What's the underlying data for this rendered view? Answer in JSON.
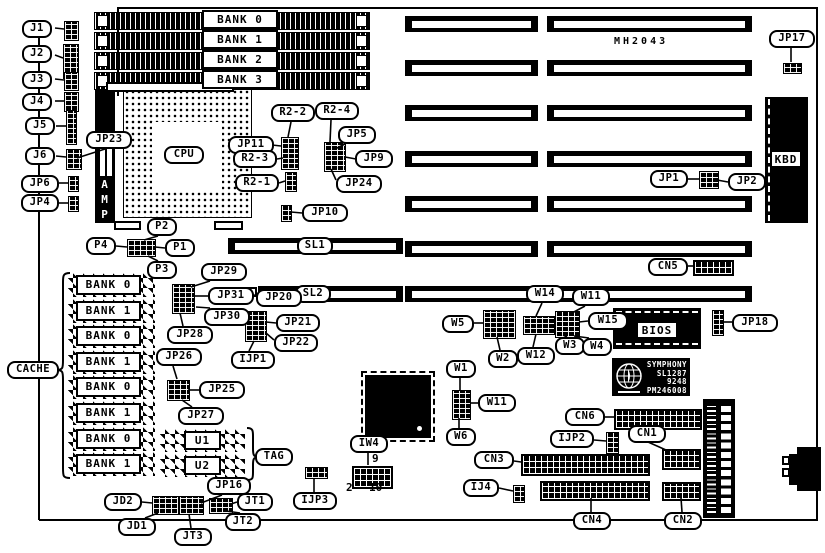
{
  "diagram": {
    "board_label": "MH2043",
    "chip_texts": {
      "cpu": "CPU",
      "amp": "AMP",
      "kbd": "KBD",
      "bios": "BIOS"
    },
    "symphony_lines": [
      "SYMPHONY",
      "SL1287",
      "9248",
      "PM246008"
    ],
    "iw4_pin_numbers": {
      "top_right": "9",
      "bottom_left": "2",
      "bottom_right": "10"
    },
    "memory_bank_labels": [
      "BANK 0",
      "BANK 1",
      "BANK 2",
      "BANK 3"
    ],
    "cache_bank_labels": [
      "BANK 0",
      "BANK 1",
      "BANK 0",
      "BANK 1",
      "BANK 0",
      "BANK 1",
      "BANK 0",
      "BANK 1"
    ],
    "tag_chip_labels": [
      "U1",
      "U2"
    ],
    "callouts": [
      {
        "t": "J1",
        "x": 22,
        "y": 20,
        "w": 30
      },
      {
        "t": "J2",
        "x": 22,
        "y": 45,
        "w": 30
      },
      {
        "t": "J3",
        "x": 22,
        "y": 71,
        "w": 30
      },
      {
        "t": "J4",
        "x": 22,
        "y": 93,
        "w": 30
      },
      {
        "t": "J5",
        "x": 25,
        "y": 117,
        "w": 30
      },
      {
        "t": "J6",
        "x": 25,
        "y": 147,
        "w": 30
      },
      {
        "t": "JP6",
        "x": 21,
        "y": 175,
        "w": 38
      },
      {
        "t": "JP4",
        "x": 21,
        "y": 194,
        "w": 38
      },
      {
        "t": "JP23",
        "x": 86,
        "y": 131,
        "w": 46
      },
      {
        "t": "JP17",
        "x": 769,
        "y": 30,
        "w": 46
      },
      {
        "t": "R2-2",
        "x": 271,
        "y": 104,
        "w": 44
      },
      {
        "t": "R2-4",
        "x": 315,
        "y": 102,
        "w": 44
      },
      {
        "t": "JP5",
        "x": 338,
        "y": 126,
        "w": 38
      },
      {
        "t": "JP11",
        "x": 228,
        "y": 136,
        "w": 46
      },
      {
        "t": "R2-3",
        "x": 233,
        "y": 150,
        "w": 44
      },
      {
        "t": "JP9",
        "x": 355,
        "y": 150,
        "w": 38
      },
      {
        "t": "R2-1",
        "x": 235,
        "y": 174,
        "w": 44
      },
      {
        "t": "JP24",
        "x": 336,
        "y": 175,
        "w": 46
      },
      {
        "t": "JP10",
        "x": 302,
        "y": 204,
        "w": 46
      },
      {
        "t": "JP1",
        "x": 650,
        "y": 170,
        "w": 38
      },
      {
        "t": "JP2",
        "x": 728,
        "y": 173,
        "w": 38
      },
      {
        "t": "P2",
        "x": 147,
        "y": 218,
        "w": 30
      },
      {
        "t": "P4",
        "x": 86,
        "y": 237,
        "w": 30
      },
      {
        "t": "P1",
        "x": 165,
        "y": 239,
        "w": 30
      },
      {
        "t": "P3",
        "x": 147,
        "y": 261,
        "w": 30
      },
      {
        "t": "SL1",
        "x": 297,
        "y": 237,
        "w": 36
      },
      {
        "t": "SL2",
        "x": 295,
        "y": 285,
        "w": 36
      },
      {
        "t": "CN5",
        "x": 648,
        "y": 258,
        "w": 40
      },
      {
        "t": "JP29",
        "x": 201,
        "y": 263,
        "w": 46
      },
      {
        "t": "JP31",
        "x": 208,
        "y": 287,
        "w": 46
      },
      {
        "t": "JP20",
        "x": 256,
        "y": 289,
        "w": 46
      },
      {
        "t": "JP30",
        "x": 204,
        "y": 308,
        "w": 46
      },
      {
        "t": "JP28",
        "x": 167,
        "y": 326,
        "w": 46
      },
      {
        "t": "JP21",
        "x": 276,
        "y": 314,
        "w": 44
      },
      {
        "t": "JP22",
        "x": 274,
        "y": 334,
        "w": 44
      },
      {
        "t": "IJP1",
        "x": 231,
        "y": 351,
        "w": 44
      },
      {
        "t": "JP26",
        "x": 156,
        "y": 348,
        "w": 46
      },
      {
        "t": "JP25",
        "x": 199,
        "y": 381,
        "w": 46
      },
      {
        "t": "JP27",
        "x": 178,
        "y": 407,
        "w": 46
      },
      {
        "t": "CACHE",
        "x": 7,
        "y": 361,
        "w": 52
      },
      {
        "t": "W14",
        "x": 526,
        "y": 285,
        "w": 38
      },
      {
        "t": "W11",
        "x": 572,
        "y": 288,
        "w": 38
      },
      {
        "t": "W5",
        "x": 442,
        "y": 315,
        "w": 32
      },
      {
        "t": "W15",
        "x": 588,
        "y": 312,
        "w": 40
      },
      {
        "t": "JP18",
        "x": 732,
        "y": 314,
        "w": 46
      },
      {
        "t": "W3",
        "x": 555,
        "y": 337,
        "w": 30
      },
      {
        "t": "W4",
        "x": 582,
        "y": 338,
        "w": 30
      },
      {
        "t": "W2",
        "x": 488,
        "y": 350,
        "w": 30
      },
      {
        "t": "W12",
        "x": 517,
        "y": 347,
        "w": 38
      },
      {
        "t": "W1",
        "x": 446,
        "y": 360,
        "w": 30
      },
      {
        "t": "W11",
        "x": 478,
        "y": 394,
        "w": 38
      },
      {
        "t": "W6",
        "x": 446,
        "y": 428,
        "w": 30
      },
      {
        "t": "IW4",
        "x": 350,
        "y": 435,
        "w": 38
      },
      {
        "t": "IJP3",
        "x": 293,
        "y": 492,
        "w": 44
      },
      {
        "t": "CN6",
        "x": 565,
        "y": 408,
        "w": 40
      },
      {
        "t": "IJP2",
        "x": 550,
        "y": 430,
        "w": 44
      },
      {
        "t": "CN1",
        "x": 628,
        "y": 425,
        "w": 38
      },
      {
        "t": "CN3",
        "x": 474,
        "y": 451,
        "w": 40
      },
      {
        "t": "IJ4",
        "x": 463,
        "y": 479,
        "w": 36
      },
      {
        "t": "CN4",
        "x": 573,
        "y": 512,
        "w": 38
      },
      {
        "t": "CN2",
        "x": 664,
        "y": 512,
        "w": 38
      },
      {
        "t": "JP16",
        "x": 207,
        "y": 477,
        "w": 44
      },
      {
        "t": "JD2",
        "x": 104,
        "y": 493,
        "w": 38
      },
      {
        "t": "JD1",
        "x": 118,
        "y": 518,
        "w": 38
      },
      {
        "t": "JT3",
        "x": 174,
        "y": 528,
        "w": 38
      },
      {
        "t": "JT2",
        "x": 225,
        "y": 513,
        "w": 36
      },
      {
        "t": "JT1",
        "x": 237,
        "y": 493,
        "w": 36
      },
      {
        "t": "TAG",
        "x": 255,
        "y": 448,
        "w": 38
      }
    ],
    "jumpers": [
      {
        "n": "j1-block",
        "x": 64,
        "y": 21,
        "w": 13,
        "h": 18
      },
      {
        "n": "j2-block",
        "x": 63,
        "y": 44,
        "w": 14,
        "h": 33
      },
      {
        "n": "j3-block",
        "x": 64,
        "y": 72,
        "w": 13,
        "h": 17
      },
      {
        "n": "j4-block",
        "x": 64,
        "y": 92,
        "w": 13,
        "h": 18
      },
      {
        "n": "j5-block",
        "x": 66,
        "y": 110,
        "w": 9,
        "h": 33
      },
      {
        "n": "j6-jp23-block",
        "x": 66,
        "y": 149,
        "w": 14,
        "h": 19
      },
      {
        "n": "jp6-block",
        "x": 68,
        "y": 176,
        "w": 9,
        "h": 14
      },
      {
        "n": "jp4-block",
        "x": 68,
        "y": 196,
        "w": 9,
        "h": 14
      },
      {
        "n": "jp17-block",
        "x": 783,
        "y": 63,
        "w": 17,
        "h": 9
      },
      {
        "n": "jp11-r2-block",
        "x": 281,
        "y": 137,
        "w": 16,
        "h": 31
      },
      {
        "n": "jp5-jp9-jp24-block",
        "x": 324,
        "y": 142,
        "w": 20,
        "h": 28
      },
      {
        "n": "r2-1-block",
        "x": 285,
        "y": 172,
        "w": 10,
        "h": 18
      },
      {
        "n": "jp10-block",
        "x": 281,
        "y": 205,
        "w": 9,
        "h": 15
      },
      {
        "n": "jp1-jp2-block",
        "x": 699,
        "y": 171,
        "w": 18,
        "h": 16
      },
      {
        "n": "p1-p2-p3-p4-block",
        "x": 127,
        "y": 239,
        "w": 27,
        "h": 16
      },
      {
        "n": "jp29-jp31-jp30-jp28-block",
        "x": 172,
        "y": 284,
        "w": 21,
        "h": 28
      },
      {
        "n": "jp21-jp22-ijp1-block",
        "x": 245,
        "y": 311,
        "w": 20,
        "h": 29
      },
      {
        "n": "jp26-jp25-jp27-block",
        "x": 167,
        "y": 380,
        "w": 21,
        "h": 19
      },
      {
        "n": "w5-block",
        "x": 483,
        "y": 310,
        "w": 31,
        "h": 27
      },
      {
        "n": "w14-w12-block",
        "x": 523,
        "y": 316,
        "w": 30,
        "h": 17
      },
      {
        "n": "w15-w3-w4-block",
        "x": 555,
        "y": 311,
        "w": 23,
        "h": 25
      },
      {
        "n": "jp18-block",
        "x": 712,
        "y": 310,
        "w": 10,
        "h": 24
      },
      {
        "n": "w1-w11-w6-block",
        "x": 452,
        "y": 390,
        "w": 17,
        "h": 28
      },
      {
        "n": "ijp3-block",
        "x": 305,
        "y": 467,
        "w": 21,
        "h": 10
      },
      {
        "n": "ij4-block",
        "x": 513,
        "y": 485,
        "w": 10,
        "h": 16
      },
      {
        "n": "ijp2-block",
        "x": 606,
        "y": 432,
        "w": 11,
        "h": 20
      },
      {
        "n": "jd2-jd1-block",
        "x": 152,
        "y": 496,
        "w": 25,
        "h": 17
      },
      {
        "n": "jt3-jp16-block",
        "x": 179,
        "y": 496,
        "w": 23,
        "h": 17
      },
      {
        "n": "jt1-jt2-block",
        "x": 209,
        "y": 498,
        "w": 22,
        "h": 14
      }
    ],
    "pads": [
      {
        "n": "jp20-pad",
        "x": 246,
        "y": 287,
        "w": 11,
        "h": 10
      }
    ],
    "connectors": [
      {
        "n": "cn5-connector",
        "x": 693,
        "y": 260,
        "w": 37,
        "h": 12
      },
      {
        "n": "cn6-connector",
        "x": 614,
        "y": 409,
        "w": 84,
        "h": 17
      },
      {
        "n": "cn1-connector",
        "x": 662,
        "y": 449,
        "w": 35,
        "h": 17
      },
      {
        "n": "cn3-connector",
        "x": 521,
        "y": 454,
        "w": 125,
        "h": 18
      },
      {
        "n": "cn4-connector",
        "x": 540,
        "y": 481,
        "w": 106,
        "h": 16
      },
      {
        "n": "cn2-connector",
        "x": 662,
        "y": 482,
        "w": 35,
        "h": 15
      },
      {
        "n": "iw4-header",
        "x": 352,
        "y": 466,
        "w": 37,
        "h": 19
      }
    ],
    "isa_slots": [
      {
        "x": 405,
        "y": 16,
        "w": 133
      },
      {
        "x": 547,
        "y": 16,
        "w": 205
      },
      {
        "x": 405,
        "y": 60,
        "w": 133
      },
      {
        "x": 547,
        "y": 60,
        "w": 205
      },
      {
        "x": 405,
        "y": 105,
        "w": 133
      },
      {
        "x": 547,
        "y": 105,
        "w": 205
      },
      {
        "x": 405,
        "y": 151,
        "w": 133
      },
      {
        "x": 547,
        "y": 151,
        "w": 205
      },
      {
        "x": 405,
        "y": 196,
        "w": 133
      },
      {
        "x": 547,
        "y": 196,
        "w": 205
      },
      {
        "x": 405,
        "y": 241,
        "w": 133
      },
      {
        "x": 547,
        "y": 241,
        "w": 205
      },
      {
        "x": 405,
        "y": 286,
        "w": 133
      },
      {
        "x": 547,
        "y": 286,
        "w": 205
      },
      {
        "x": 228,
        "y": 238,
        "w": 175
      },
      {
        "x": 258,
        "y": 286,
        "w": 145
      }
    ],
    "simm_slots": [
      {
        "x": 94,
        "y": 12,
        "w": 274
      },
      {
        "x": 94,
        "y": 32,
        "w": 274
      },
      {
        "x": 94,
        "y": 52,
        "w": 274
      },
      {
        "x": 94,
        "y": 72,
        "w": 274
      }
    ],
    "memory_bank_boxes": [
      {
        "x": 202,
        "y": 10
      },
      {
        "x": 202,
        "y": 30
      },
      {
        "x": 202,
        "y": 50
      },
      {
        "x": 202,
        "y": 70
      }
    ],
    "cache_chip_rows": [
      273,
      299,
      324,
      350,
      375,
      401,
      427,
      452
    ],
    "cache_chip_geom": {
      "x": 68,
      "w": 87,
      "h": 24
    },
    "tag_chips": [
      {
        "x": 160,
        "y": 429,
        "w": 85,
        "h": 23
      },
      {
        "x": 160,
        "y": 454,
        "w": 85,
        "h": 23
      }
    ],
    "texts": [
      {
        "t": "9",
        "x": 372,
        "y": 452,
        "cls": "pin"
      },
      {
        "t": "2",
        "x": 346,
        "y": 481,
        "cls": "pin"
      },
      {
        "t": "10",
        "x": 369,
        "y": 481,
        "cls": "pin"
      }
    ],
    "leaders": [
      [
        55,
        28,
        64,
        29
      ],
      [
        55,
        55,
        63,
        58
      ],
      [
        55,
        79,
        64,
        80
      ],
      [
        55,
        101,
        64,
        101
      ],
      [
        56,
        126,
        66,
        126
      ],
      [
        56,
        156,
        66,
        157
      ],
      [
        59,
        183,
        68,
        183
      ],
      [
        59,
        203,
        68,
        203
      ],
      [
        105,
        149,
        77,
        158
      ],
      [
        791,
        48,
        791,
        62
      ],
      [
        291,
        122,
        288,
        137
      ],
      [
        331,
        120,
        330,
        142
      ],
      [
        345,
        144,
        335,
        149
      ],
      [
        272,
        145,
        281,
        146
      ],
      [
        277,
        159,
        283,
        158
      ],
      [
        356,
        159,
        345,
        157
      ],
      [
        279,
        183,
        285,
        181
      ],
      [
        336,
        180,
        331,
        169
      ],
      [
        302,
        213,
        291,
        212
      ],
      [
        688,
        179,
        699,
        179
      ],
      [
        728,
        182,
        717,
        180
      ],
      [
        158,
        236,
        144,
        240
      ],
      [
        116,
        246,
        127,
        247
      ],
      [
        165,
        248,
        155,
        247
      ],
      [
        158,
        261,
        148,
        256
      ],
      [
        688,
        266,
        693,
        266
      ],
      [
        210,
        281,
        191,
        287
      ],
      [
        208,
        296,
        194,
        296
      ],
      [
        210,
        308,
        196,
        307
      ],
      [
        183,
        326,
        180,
        313
      ],
      [
        256,
        296,
        252,
        294
      ],
      [
        276,
        323,
        266,
        322
      ],
      [
        274,
        340,
        266,
        333
      ],
      [
        249,
        351,
        254,
        341
      ],
      [
        173,
        366,
        177,
        379
      ],
      [
        199,
        390,
        188,
        390
      ],
      [
        192,
        407,
        182,
        400
      ],
      [
        542,
        303,
        536,
        316
      ],
      [
        585,
        306,
        572,
        313
      ],
      [
        474,
        323,
        483,
        323
      ],
      [
        588,
        321,
        579,
        322
      ],
      [
        732,
        322,
        722,
        322
      ],
      [
        567,
        337,
        563,
        335
      ],
      [
        589,
        338,
        574,
        336
      ],
      [
        500,
        350,
        497,
        337
      ],
      [
        533,
        347,
        536,
        334
      ],
      [
        460,
        378,
        460,
        390
      ],
      [
        478,
        403,
        470,
        403
      ],
      [
        459,
        428,
        459,
        418
      ],
      [
        368,
        453,
        368,
        465
      ],
      [
        314,
        492,
        314,
        478
      ],
      [
        605,
        417,
        614,
        417
      ],
      [
        594,
        440,
        606,
        441
      ],
      [
        648,
        442,
        666,
        450
      ],
      [
        514,
        461,
        521,
        462
      ],
      [
        499,
        488,
        513,
        491
      ],
      [
        591,
        512,
        591,
        498
      ],
      [
        682,
        512,
        681,
        498
      ],
      [
        222,
        495,
        201,
        503
      ],
      [
        142,
        502,
        152,
        503
      ],
      [
        145,
        518,
        158,
        513
      ],
      [
        191,
        528,
        189,
        514
      ],
      [
        240,
        513,
        226,
        511
      ],
      [
        237,
        502,
        231,
        504
      ]
    ]
  }
}
